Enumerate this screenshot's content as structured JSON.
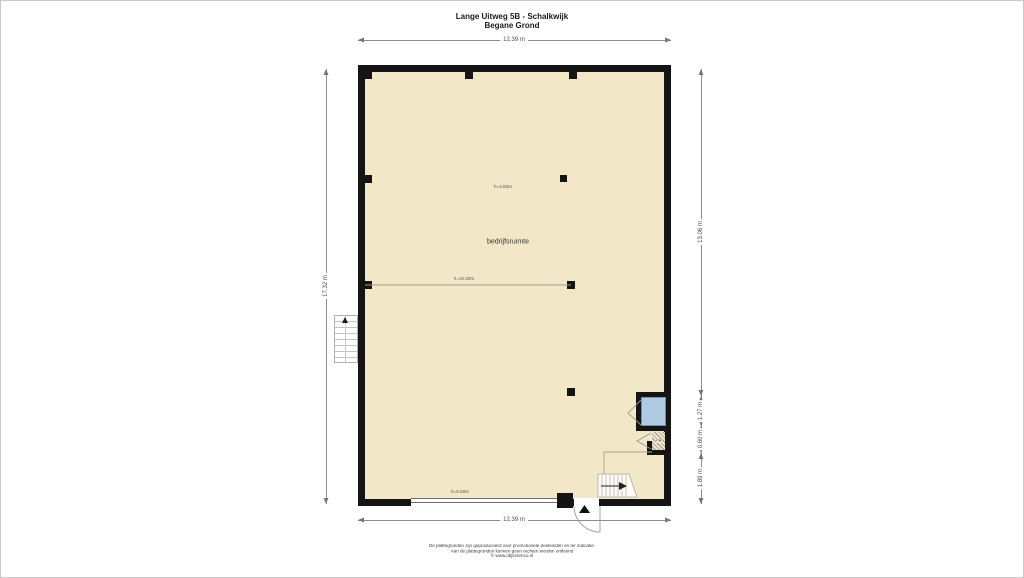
{
  "header": {
    "title": "Lange Uitweg 5B - Schalkwijk",
    "subtitle": "Begane Grond"
  },
  "plan": {
    "room_label": "bedrijfsruimte",
    "closet_label": "mk",
    "ceiling_height_label": "h=3.85m",
    "span_height_label": "h=10.00m",
    "door_height_label": "h=6.00m"
  },
  "dimensions": {
    "top": "12.39 m",
    "bottom": "12.39 m",
    "left": "17.32 m",
    "right": [
      "13.06 m",
      "1.27 m",
      "0.60 m",
      "1.89 m"
    ]
  },
  "footer": {
    "line1": "De plattegronden zijn geproduceerd voor promotionele doeleinden en ter indicatie.",
    "line2": "Aan de plattegronden kunnen geen rechten worden ontleend",
    "line3": "© www.objectenco.nl"
  },
  "colors": {
    "floor": "#f2e8c8",
    "wall": "#141414",
    "window_glass": "#aecbe3",
    "dimension_line": "#8c8c8c"
  }
}
